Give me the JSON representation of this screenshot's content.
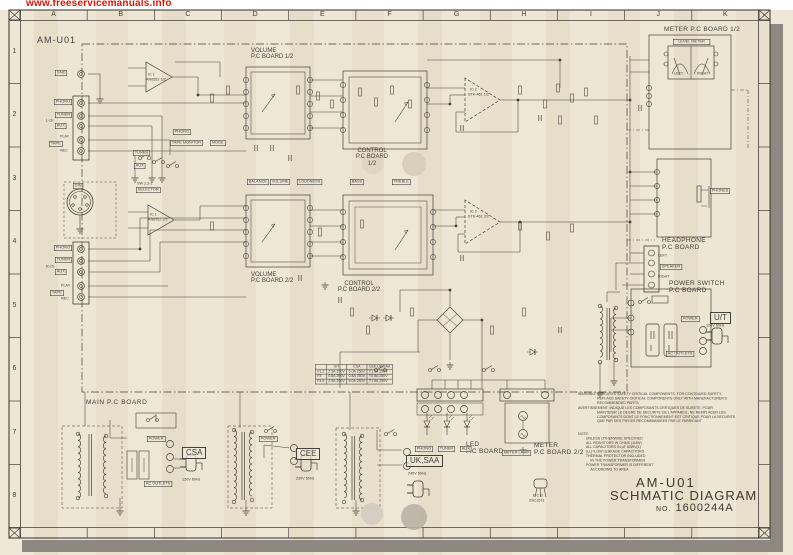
{
  "colors": {
    "paper": "#ece4d1",
    "ink": "#44403a",
    "accent_red": "#dd1404",
    "shadow": "#8d8880"
  },
  "watermark": {
    "url": "www.freeservicemanuals.info"
  },
  "grid": {
    "columns": [
      "A",
      "B",
      "C",
      "D",
      "E",
      "F",
      "G",
      "H",
      "I",
      "J",
      "K"
    ],
    "rows": [
      "1",
      "2",
      "3",
      "4",
      "5",
      "6",
      "7",
      "8"
    ]
  },
  "schematic": {
    "model": "AM-U01",
    "boards": {
      "meter1": "METER  P.C BOARD 1/2",
      "volume1_l1": "VOLUME",
      "volume1_l2": "P.C BOARD 1/2",
      "control1_l1": "CONTROL",
      "control1_l2": "P.C BOARD",
      "control1_l3": "1/2",
      "volume2_l1": "VOLUME",
      "volume2_l2": "P.C BOARD 2/2",
      "control2_l1": "CONTROL",
      "control2_l2": "P.C BOARD 2/2",
      "headphone_l1": "HEADPHONE",
      "headphone_l2": "P.C BOARD",
      "power_switch_l1": "POWER SWITCH",
      "power_switch_l2": "P.C BOARD",
      "main": "MAIN P.C BOARD",
      "led_l1": "LED",
      "led_l2": "P.C BOARD",
      "meter2_l1": "METER",
      "meter2_l2": "P.C BOARD 2/2"
    },
    "jacks": {
      "gnd": "GND",
      "phono": "PHONO",
      "tuner": "TUNER",
      "aux": "AUX",
      "play": "PLAY",
      "tape": "TAPE",
      "rec": "REC",
      "l_ch": "L-ch",
      "r_ch": "R-ch",
      "din": "DIN",
      "phones": "PHONES",
      "speaker": "SPEAKER",
      "left": "LEFT",
      "right": "RIGHT"
    },
    "controls": {
      "balance": "BALANCE",
      "volume": "VOLUME",
      "loudness": "LOUDNESS",
      "bass": "BASS",
      "treble": "TREBLE",
      "selector": "SELECTOR",
      "selector_sw": "SW 2,3-1",
      "tape_monitor": "TAPE MONITOR",
      "mode": "MODE"
    },
    "ics": {
      "ic1_ref": "IC 1",
      "ic1a": "AN6552 1/2",
      "ic1b": "AN6552 2/2",
      "ic2_ref": "IC 2",
      "ic2a": "STK-461 1/2",
      "ic2b": "STK-461 2/2"
    },
    "meter": {
      "level_meter": "LEVEL  METER",
      "left": "LEFT",
      "right": "RIGHT",
      "meter_lamp": "METER LAMP"
    },
    "power": {
      "power": "POWER",
      "ac_outlets": "AC OUTLETS",
      "ut": "U/T",
      "csa": "CSA",
      "cee": "CEE",
      "uk_saa": "UK,SAA",
      "ut_v": "120V 60Hz",
      "csa_v": "120V 60Hz",
      "cee_v": "220V 50Hz",
      "uk_saa_v": "240V 50Hz"
    },
    "transistor": {
      "pins": "E C B",
      "part": "2SC1571"
    },
    "fuse_table": {
      "headers": [
        "",
        "U/T",
        "CSA",
        "CEE,UK,SAA"
      ],
      "rows": [
        [
          "F1,2",
          "2.5A 250V",
          "5.0A 250V",
          "T1.6A 250V"
        ],
        [
          "F3",
          "0.8A 250V",
          "0.8A 250V",
          "T0.8A 250V"
        ],
        [
          "F4,5",
          "2.5A 250V",
          "5.0A 250V",
          "T1.6A 250V"
        ]
      ]
    },
    "warning_lines": [
      "WARNING:  INDICATES SAFETY CRITICAL COMPONENTS. FOR CONTINUED SAFETY,",
      "REPLACE SAFETY CRITICAL COMPONENTS ONLY WITH MANUFACTURER'S",
      "RECOMMENDED PARTS",
      "AVERTISSEMENT:  INDIQUE LES COMPOSANTS CRITIQUES DE SURETE. POUR",
      "MAINTENIR LE DEGRE DE SECURITE DE L'APPAREIL, NE REMPLACER LES",
      "COMPOSANTS DONT LE FONCTIONNEMENT EST CRITIQUE POUR LA SECURITE",
      "QUE PAR DES PIECES RECOMMANDEES PAR LE FABRICANT"
    ],
    "note": {
      "label": "NOTE:",
      "items": [
        "UNLESS OTHERWISE SPECIFIED",
        "ALL RESISTORS IN OHMS (1/4W)",
        "ALL CAPACITORS IN µF 50WV(L)",
        "(LL)=LOW LEAKAGE CAPACITORS",
        "THERMAL PROTECTOR INCLUDED",
        "IN THE POWER TRANSFORMER",
        "POWER TRANSFORMER IS DIFFERENT",
        "ACCORDING TO AREA"
      ]
    },
    "title_block": {
      "model": "AM-U01",
      "title": "SCHMATIC DIAGRAM",
      "no_label": "NO.",
      "number": "1600244A"
    }
  }
}
